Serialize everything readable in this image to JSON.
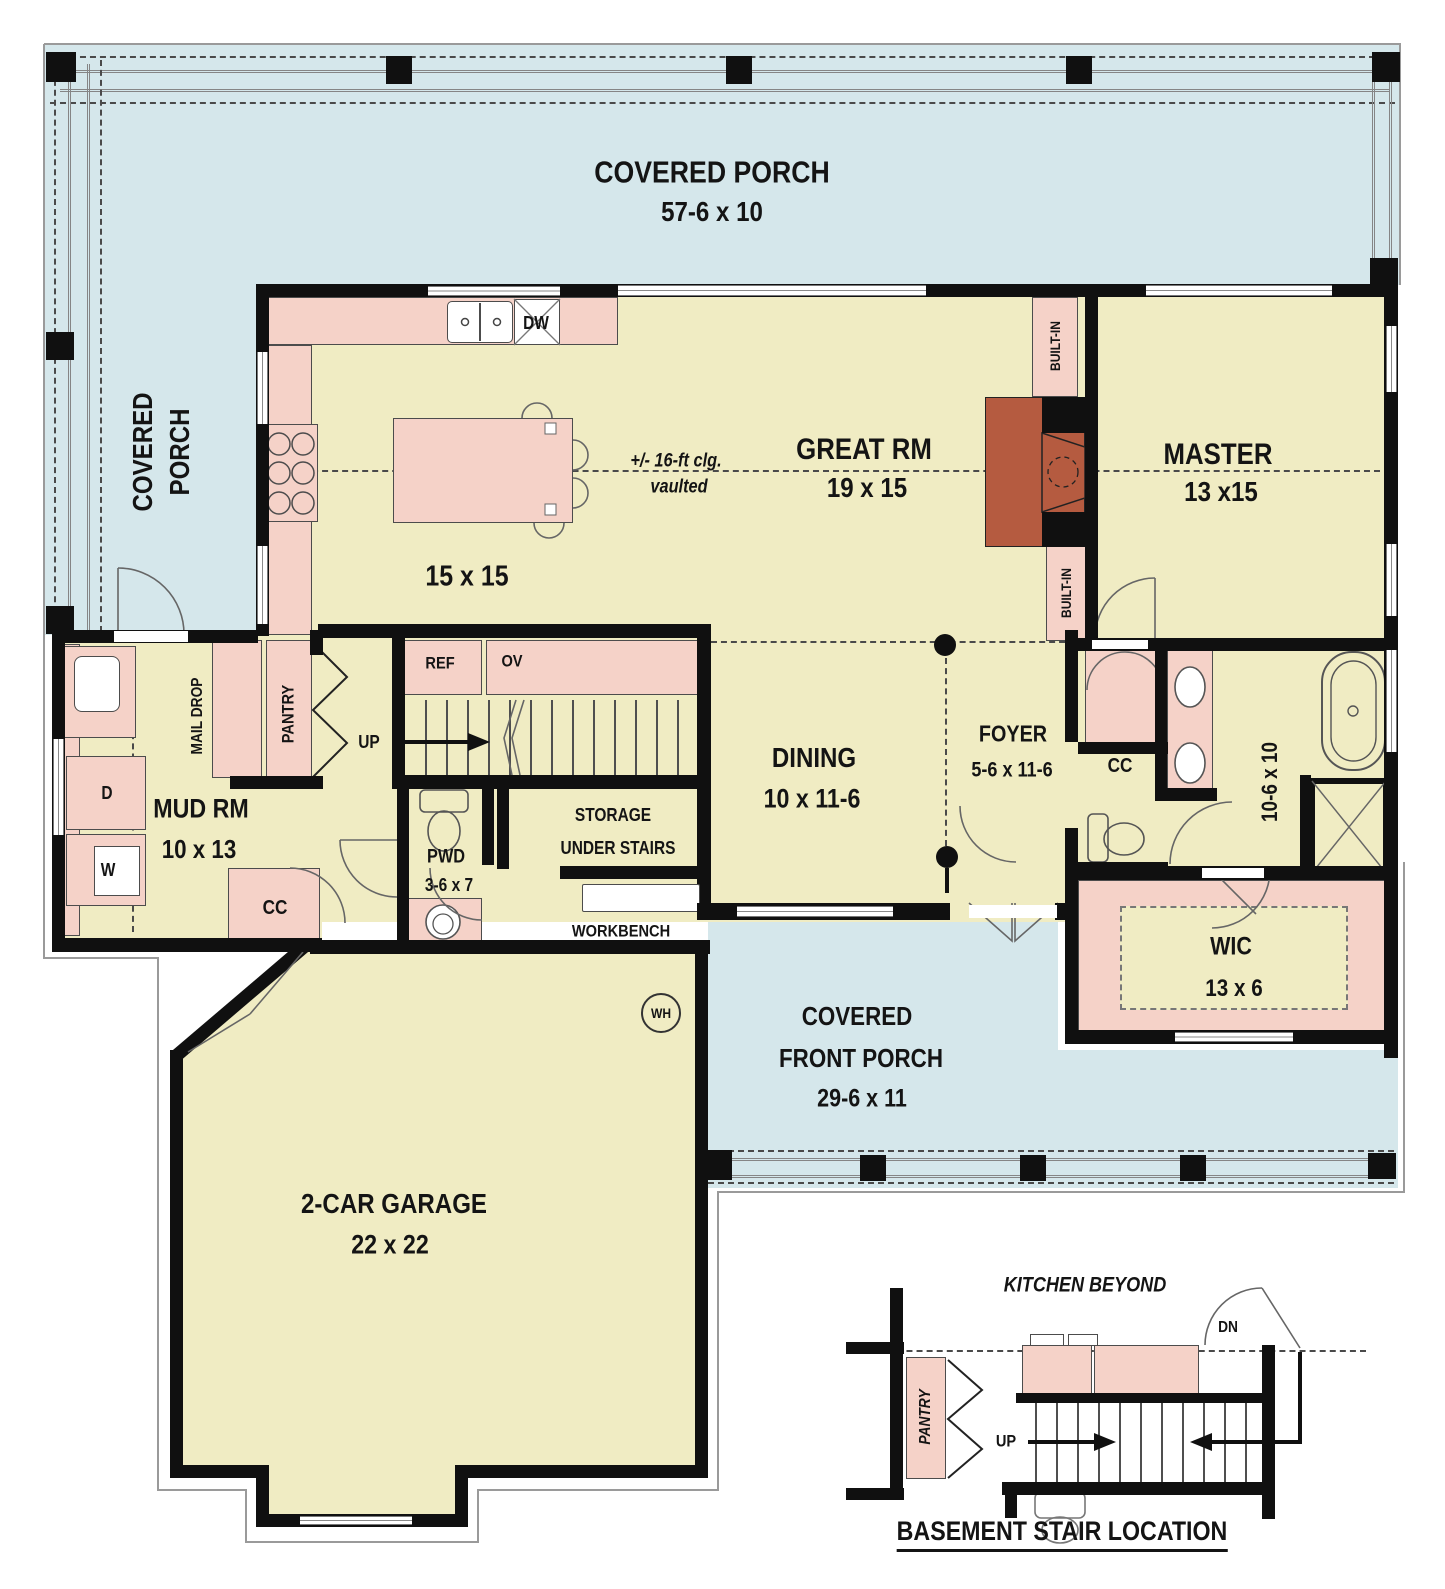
{
  "palette": {
    "porch": "#d5e7eb",
    "room": "#f0ecc3",
    "cabinet": "#f5d2c8",
    "brick": "#b55b40",
    "wall": "#101010"
  },
  "rooms": {
    "porch_top": {
      "name": "COVERED PORCH",
      "dims": "57-6 x 10"
    },
    "porch_left": {
      "line1": "COVERED",
      "line2": "PORCH"
    },
    "kitchen": {
      "dims": "15 x 15",
      "ceiling_note_line1": "+/- 16-ft clg.",
      "ceiling_note_line2": "vaulted"
    },
    "great_room": {
      "name": "GREAT RM",
      "dims": "19 x 15"
    },
    "master": {
      "name": "MASTER",
      "dims": "13 x15"
    },
    "mud_room": {
      "name": "MUD RM",
      "dims": "10 x 13"
    },
    "powder": {
      "name": "PWD",
      "dims": "3-6 x 7"
    },
    "storage": {
      "line1": "STORAGE",
      "line2": "UNDER STAIRS"
    },
    "dining": {
      "name": "DINING",
      "dims": "10 x 11-6"
    },
    "foyer": {
      "name": "FOYER",
      "dims": "5-6 x 11-6"
    },
    "master_bath": {
      "dims": "10-6 x 10"
    },
    "wic": {
      "name": "WIC",
      "dims": "13 x 6"
    },
    "front_porch": {
      "line1": "COVERED",
      "line2": "FRONT PORCH",
      "dims": "29-6 x 11"
    },
    "garage": {
      "name": "2-CAR GARAGE",
      "dims": "22 x 22"
    }
  },
  "fixtures": {
    "dishwasher": "DW",
    "refrigerator": "REF",
    "oven": "OV",
    "stairs_up": "UP",
    "mail_drop": "MAIL DROP",
    "pantry": "PANTRY",
    "built_in_upper": "BUILT-IN",
    "built_in_lower": "BUILT-IN",
    "coat_closet_mud": "CC",
    "coat_closet_foyer": "CC",
    "dryer": "D",
    "washer": "W",
    "water_heater": "WH",
    "workbench": "WORKBENCH"
  },
  "inset": {
    "heading": "KITCHEN BEYOND",
    "pantry": "PANTRY",
    "down": "DN",
    "up": "UP",
    "caption": "BASEMENT STAIR LOCATION"
  }
}
